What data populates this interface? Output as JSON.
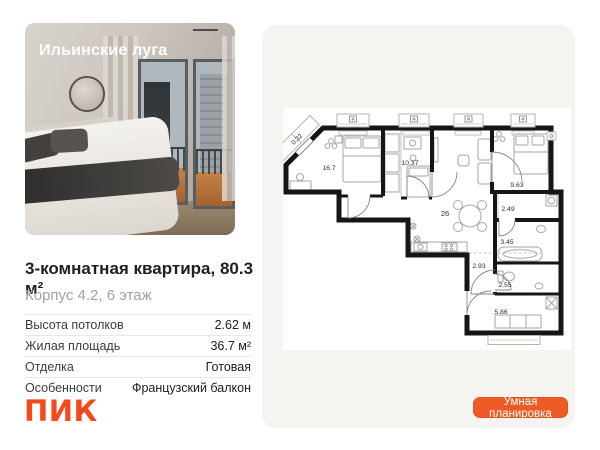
{
  "project": {
    "name": "Ильинские луга"
  },
  "listing": {
    "title": "3-комнатная квартира, 80.3 м²",
    "subtitle": "Корпус 4.2, 6 этаж"
  },
  "specs": [
    {
      "label": "Высота потолков",
      "value": "2.62 м"
    },
    {
      "label": "Жилая площадь",
      "value": "36.7 м²"
    },
    {
      "label": "Отделка",
      "value": "Готовая"
    },
    {
      "label": "Особенности",
      "value": "Французский балкон"
    }
  ],
  "floor_plan": {
    "rooms": [
      "0.32",
      "16.7",
      "10.37",
      "26",
      "9.63",
      "2.49",
      "3.45",
      "2.93",
      "2.55",
      "5.86"
    ]
  },
  "actions": {
    "smart_layout_label": "Умная планировка"
  },
  "brand": {
    "logo": "ПИК"
  },
  "colors": {
    "logo_orange": "#f4491d",
    "button_orange": "#ef5b24",
    "panel_bg": "#f5f4f1",
    "wall_black": "#161616",
    "muted_text": "#a5a19a"
  }
}
